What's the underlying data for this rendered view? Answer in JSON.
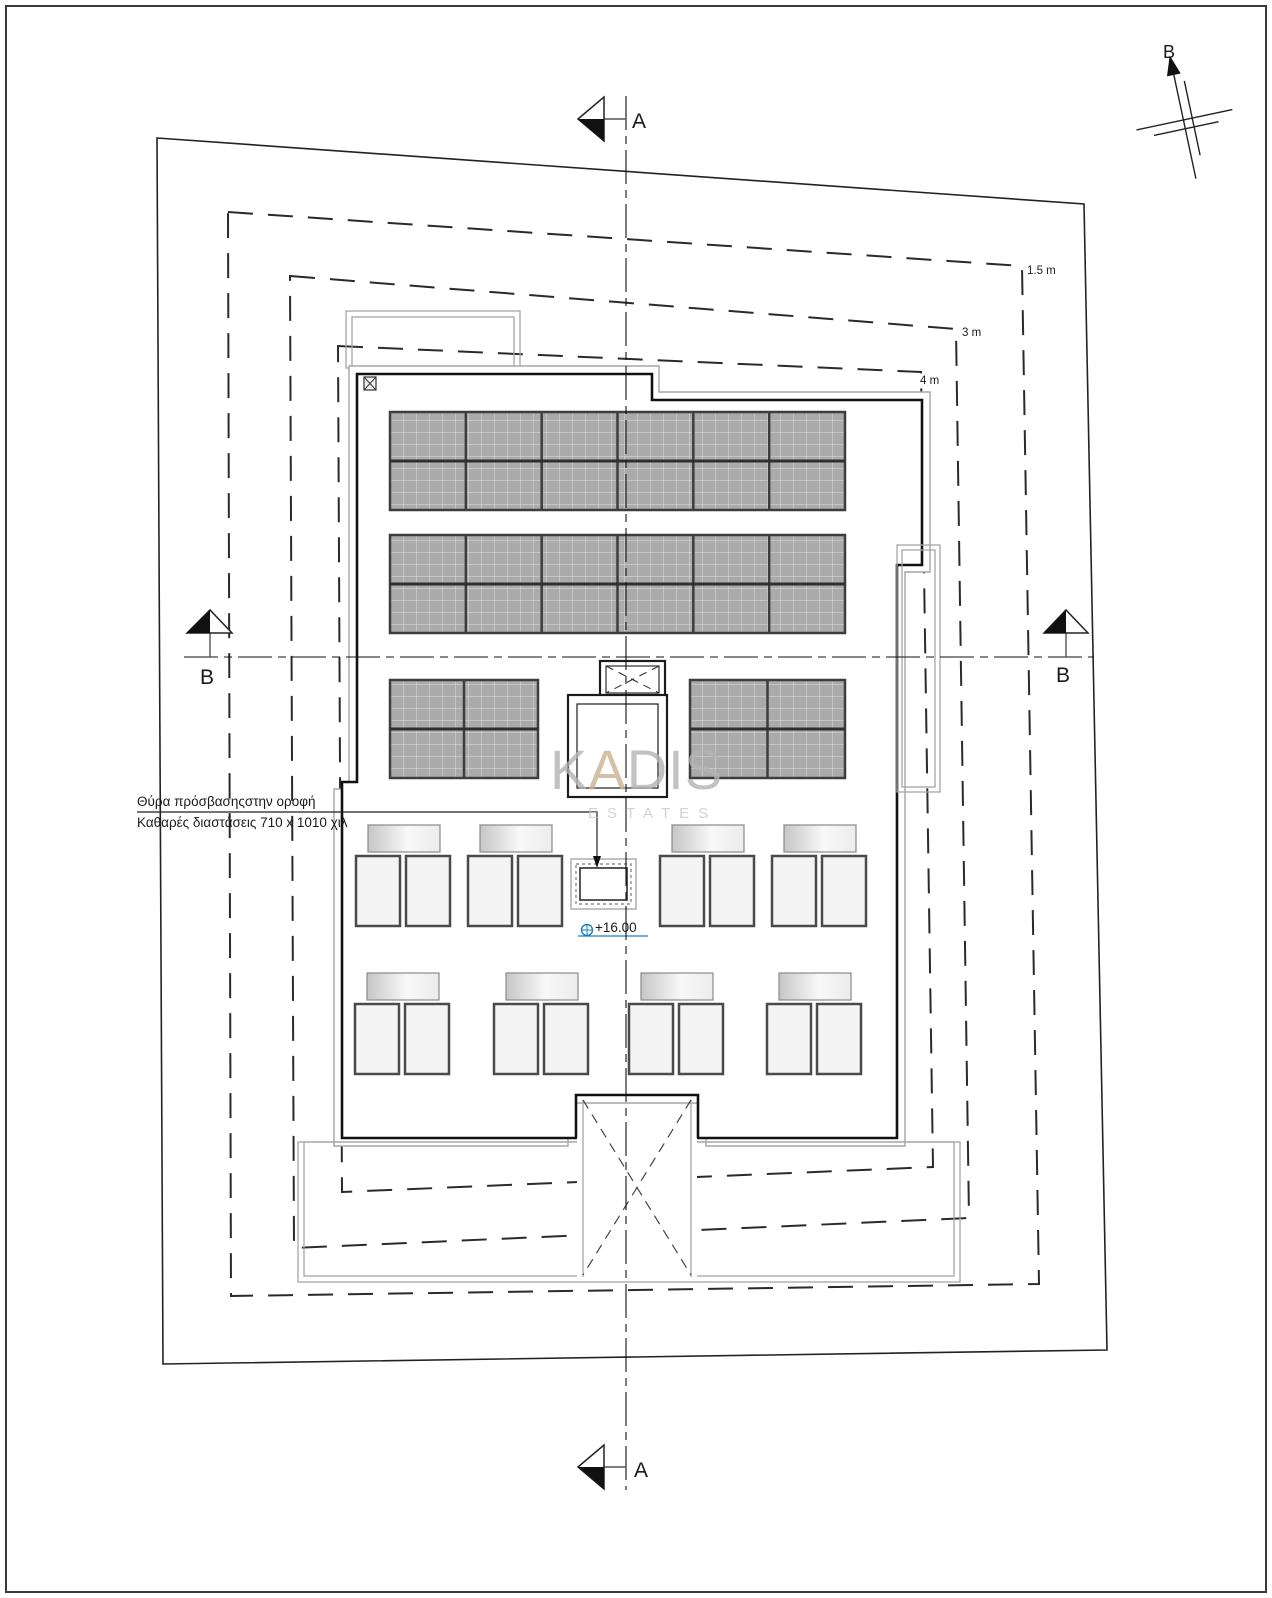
{
  "drawing": {
    "compass": {
      "label": "B"
    },
    "markers": {
      "a_top": "A",
      "a_bottom": "A",
      "b_left": "B",
      "b_right": "B"
    },
    "setback_labels": {
      "outer": "1.5 m",
      "middle": "3 m",
      "inner": "4 m"
    },
    "annotation": {
      "line1": "Θύρα πρόσβασηςστην οροφή",
      "line2": "Καθαρές διαστάσεις 710 x 1010 χιλ"
    },
    "elevation": {
      "label": "+16.00"
    },
    "watermark": {
      "part1": "K",
      "part2": "A",
      "part3": "DIS",
      "sub": "ESTATES"
    },
    "colors": {
      "line": "#1a1a1a",
      "gray_line": "#a6a6a6",
      "panel_fill": "#ababab",
      "panel_grid": "#dedede",
      "panel_border": "#3d3d3d",
      "accent_blue": "#1d7fc4",
      "watermark_gray": "#b4b4b4",
      "watermark_tan": "#cbb391"
    },
    "solar_arrays": [
      {
        "x": 390,
        "y": 412,
        "w": 455,
        "h": 98,
        "cols": 6,
        "rows": 2
      },
      {
        "x": 390,
        "y": 535,
        "w": 455,
        "h": 98,
        "cols": 6,
        "rows": 2
      },
      {
        "x": 390,
        "y": 680,
        "w": 148,
        "h": 98,
        "cols": 2,
        "rows": 2
      },
      {
        "x": 690,
        "y": 680,
        "w": 155,
        "h": 98,
        "cols": 2,
        "rows": 2
      }
    ],
    "ac_units": {
      "dims": {
        "bar_w": 72,
        "bar_h": 27,
        "panel_w": 44,
        "panel_h": 70,
        "gap": 6,
        "bar_dx": 12,
        "panel_dy": 31
      },
      "groups": [
        {
          "x": 356,
          "y": 825
        },
        {
          "x": 468,
          "y": 825
        },
        {
          "x": 660,
          "y": 825
        },
        {
          "x": 772,
          "y": 825
        },
        {
          "x": 355,
          "y": 973
        },
        {
          "x": 494,
          "y": 973
        },
        {
          "x": 629,
          "y": 973
        },
        {
          "x": 767,
          "y": 973
        }
      ]
    }
  }
}
